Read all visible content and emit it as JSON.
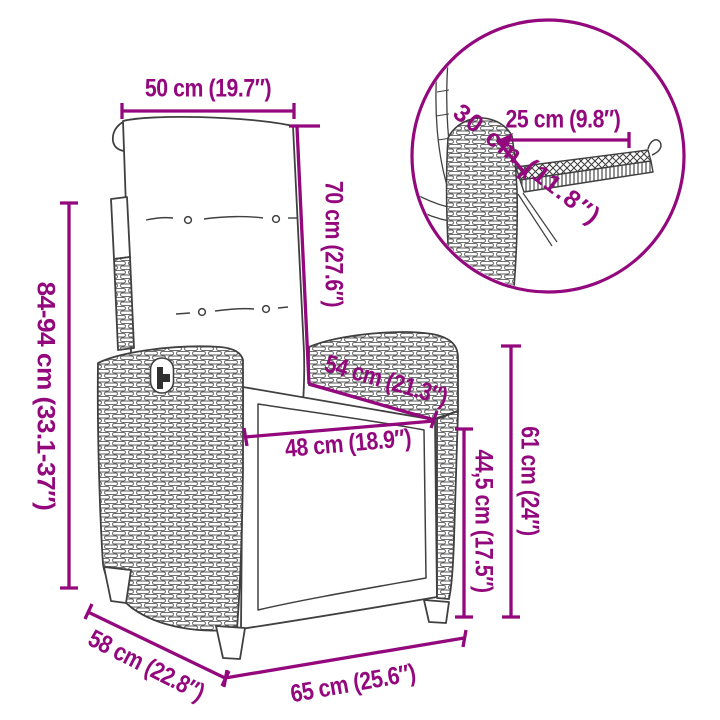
{
  "diagram": {
    "subject": "reclining garden chair with cushion and pull-out footrest",
    "colors": {
      "dimension_annotation": "#93087d",
      "line_art_outline": "#404040",
      "background": "#ffffff"
    },
    "labels": {
      "back_width": "50 cm (19.7″)",
      "back_height": "70 cm (27.6″)",
      "overall_height": "84-94 cm (33.1-37″)",
      "armrest_depth": "54 cm (21.3″)",
      "seat_width": "48 cm (18.9″)",
      "seat_height": "44,5 cm (17.5″)",
      "armrest_height": "61 cm (24″)",
      "overall_depth": "58 cm (22.8″)",
      "overall_width": "65 cm (25.6″)",
      "inset_footrest_length": "25 cm (9.8″)",
      "inset_footrest_depth": "30 cm (11.8″)"
    }
  }
}
